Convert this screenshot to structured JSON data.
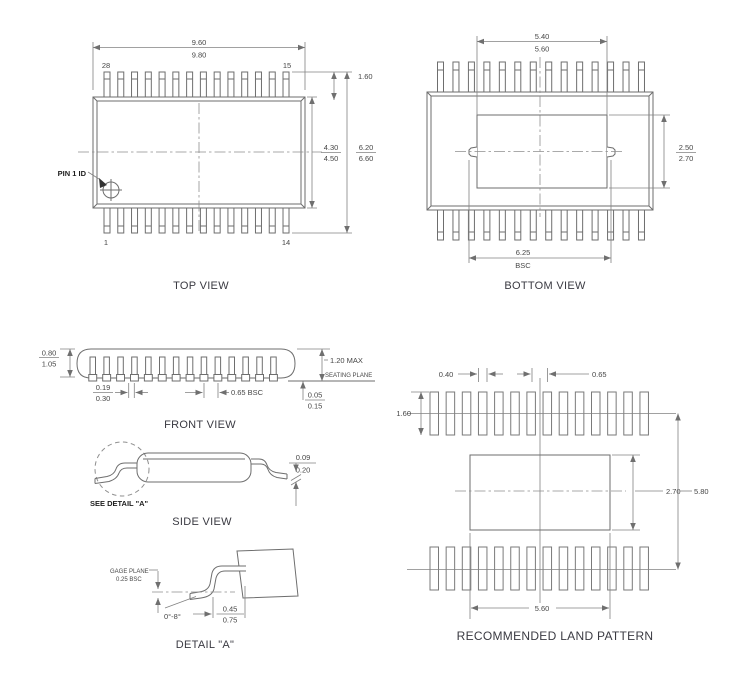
{
  "colors": {
    "background": "#ffffff",
    "line": "#6e6e6e",
    "dimension_line": "#828282",
    "text": "#474747",
    "label_text": "#3a3a42"
  },
  "drawing": {
    "pins_per_row": 14,
    "views": {
      "top": {
        "label": "TOP VIEW",
        "body_width": {
          "min": "9.60",
          "max": "9.80"
        },
        "pin_top_left": "28",
        "pin_top_right": "15",
        "pin_bottom_left": "1",
        "pin_bottom_right": "14",
        "pin1_callout": "PIN 1 ID",
        "body_length": {
          "min": "4.30",
          "max": "4.50"
        },
        "lead_span": {
          "min": "6.20",
          "max": "6.60"
        },
        "lead_length": "1.60"
      },
      "bottom": {
        "label": "BOTTOM VIEW",
        "pad_width": {
          "min": "5.40",
          "max": "5.60"
        },
        "pad_height": {
          "min": "2.50",
          "max": "2.70"
        },
        "lead_tip_span": "6.25",
        "lead_tip_span_suffix": "BSC"
      },
      "front": {
        "label": "FRONT VIEW",
        "body_thickness": {
          "min": "0.80",
          "max": "1.05"
        },
        "lead_width": {
          "min": "0.19",
          "max": "0.30"
        },
        "pitch": "0.65 BSC",
        "overall_height": "1.20 MAX",
        "seating_plane": "SEATING PLANE",
        "standoff": {
          "min": "0.05",
          "max": "0.15"
        }
      },
      "side": {
        "label": "SIDE VIEW",
        "see_detail": "SEE DETAIL \"A\"",
        "lead_thickness": {
          "min": "0.09",
          "max": "0.20"
        }
      },
      "detail_a": {
        "label": "DETAIL \"A\"",
        "gage_plane": "GAGE PLANE",
        "gage_offset": "0.25 BSC",
        "foot_angle": "0°-8°",
        "foot_length": {
          "min": "0.45",
          "max": "0.75"
        }
      },
      "land": {
        "label": "RECOMMENDED LAND PATTERN",
        "pad_width": "0.40",
        "pitch": "0.65",
        "pad_length": "1.60",
        "center_pad_height": "2.70",
        "row_center_span": "5.80",
        "center_pad_width": "5.60"
      }
    }
  }
}
